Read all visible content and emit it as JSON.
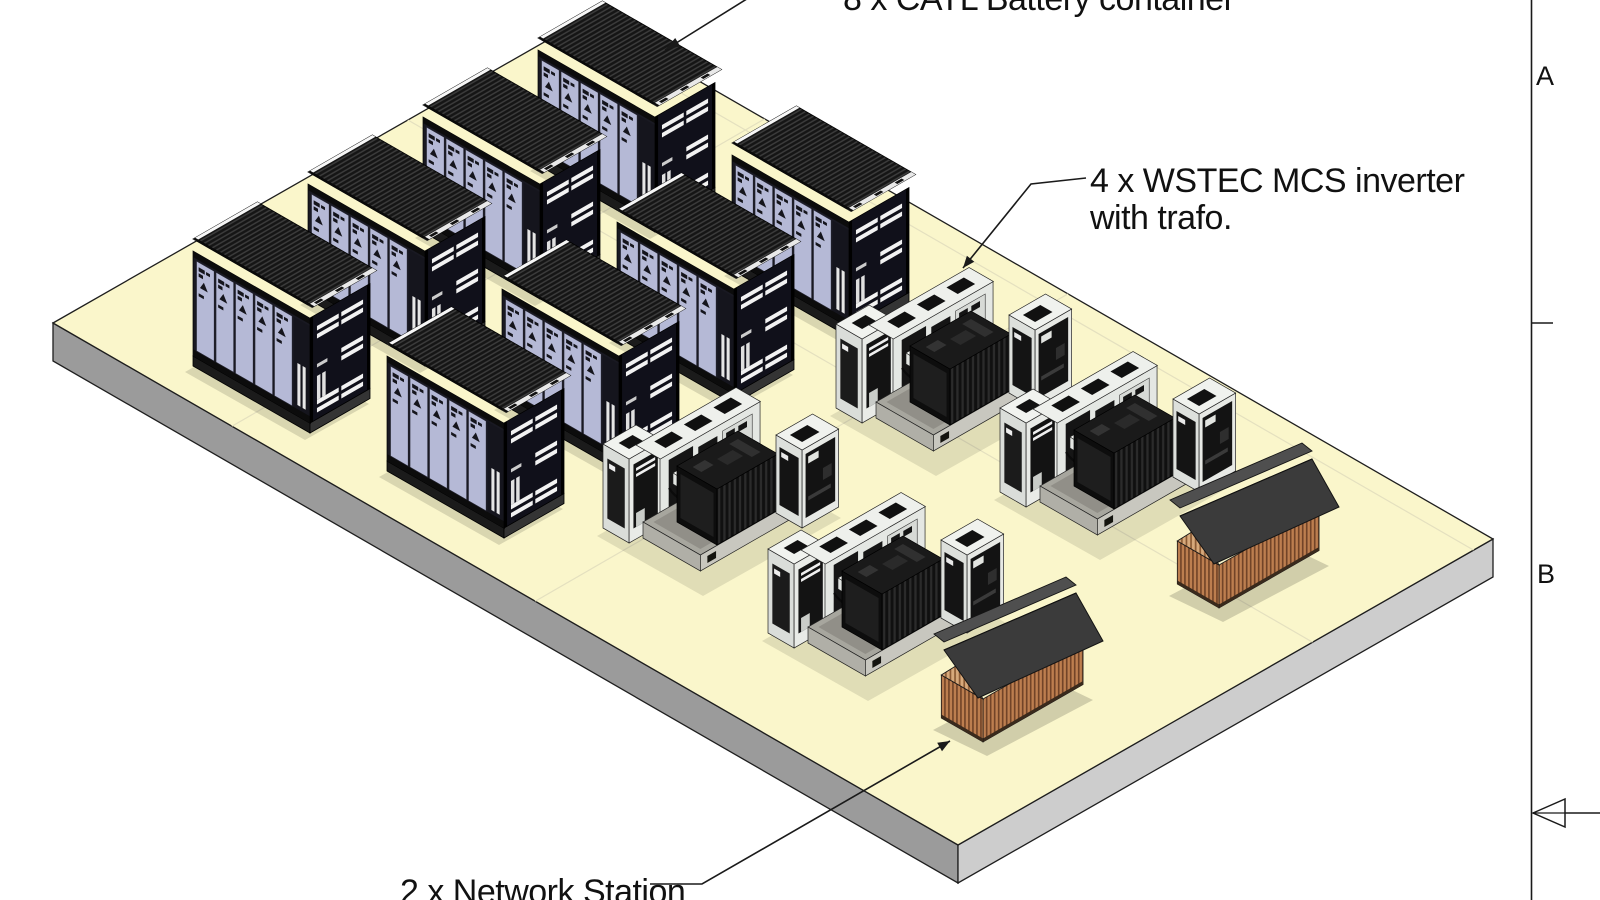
{
  "scene": {
    "kind": "isometric-site-layout-drawing",
    "labels": {
      "battery_container": "8 x CATL Battery container",
      "inverter_line1": "4 x WSTEC MCS inverter",
      "inverter_line2": "with trafo.",
      "network_station": "2 x Network Station"
    },
    "frame": {
      "zone_a": "A",
      "zone_b": "B"
    },
    "equipment": {
      "battery_containers": 8,
      "inverters_with_trafo": 4,
      "network_stations": 2
    },
    "colors": {
      "background": "#FFFFFF",
      "pad_top": "#FAF6CB",
      "pad_side_sw": "#9B9B9B",
      "pad_side_se": "#CDCDCD",
      "container_doors": "#B5B9D6",
      "container_dark": "#151515",
      "inverter_cabinet": "#E9EBE7",
      "transformer": "#141414",
      "hut_roof": "#3B3B3B",
      "hut_wood": "#BD7E4F",
      "line": "#1A1A1A"
    }
  }
}
